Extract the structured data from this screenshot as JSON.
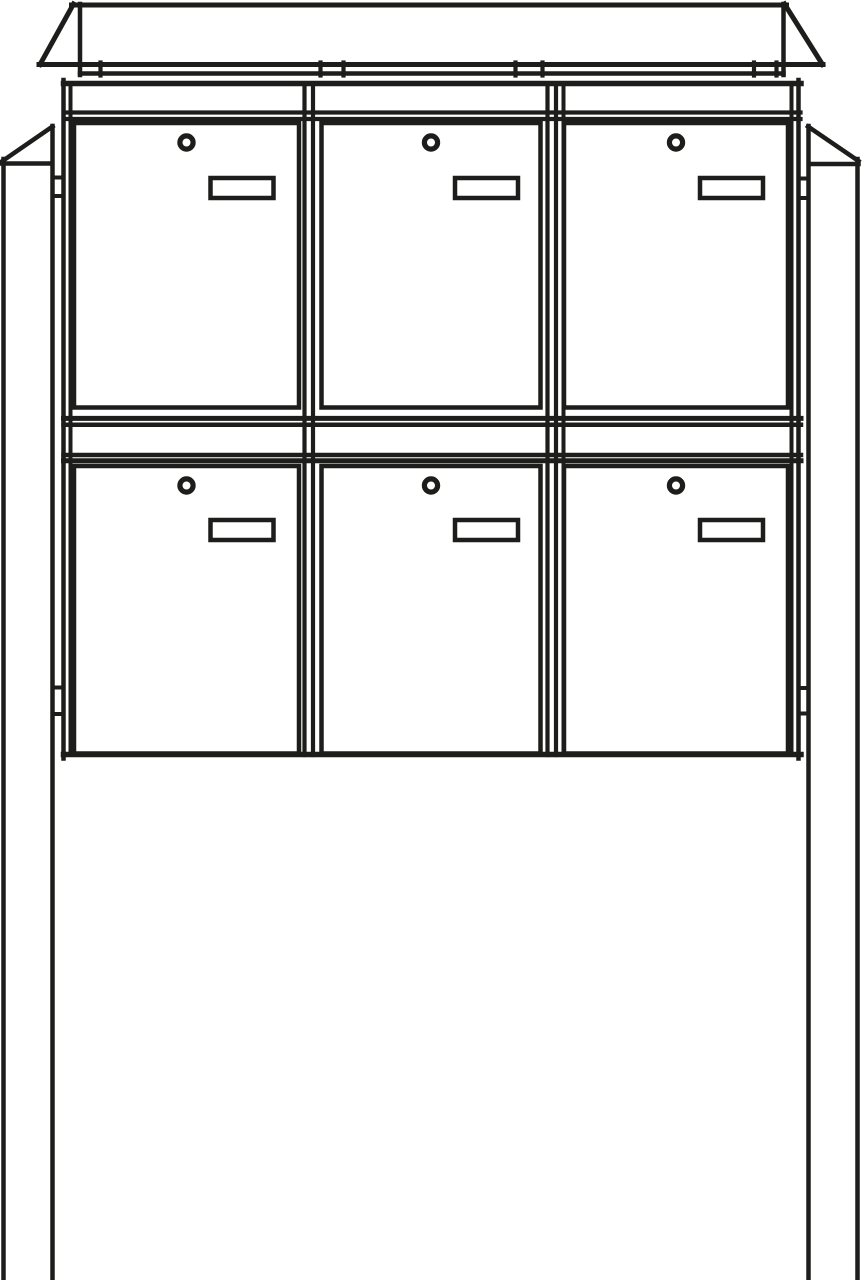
{
  "figure": {
    "kind": "technical-line-drawing",
    "subject": "Free-standing letterbox unit: 6 mailbox doors in 2 rows x 3 columns, each door with a round cylinder lock and a rectangular name plate, pitched rain cover on top, cabinet mounted on two square ground posts with side brackets",
    "rows": 2,
    "columns": 3,
    "door_count": 6
  },
  "canvas": {
    "width": 862,
    "height": 1280
  },
  "colors": {
    "background": "#ffffff",
    "line": "#1d1d1b"
  },
  "diagram": {
    "shapes": [
      {
        "kind": "line",
        "name": "roof-top-edge",
        "x1": 71.5,
        "y1": 5,
        "x2": 786.5,
        "y2": 5,
        "w": 5
      },
      {
        "kind": "line",
        "name": "roof-left-slope",
        "x1": 73.5,
        "y1": 4,
        "x2": 40,
        "y2": 64.5,
        "w": 5
      },
      {
        "kind": "line",
        "name": "roof-right-slope",
        "x1": 784.5,
        "y1": 4,
        "x2": 822.5,
        "y2": 64.5,
        "w": 5
      },
      {
        "kind": "line",
        "name": "roof-left-fold-line",
        "x1": 80,
        "y1": 4,
        "x2": 80,
        "y2": 75,
        "w": 4.5
      },
      {
        "kind": "line",
        "name": "roof-right-fold-line",
        "x1": 783.5,
        "y1": 4,
        "x2": 783.5,
        "y2": 75,
        "w": 4.5
      },
      {
        "kind": "line",
        "name": "roof-eave-rail",
        "x1": 39,
        "y1": 64.5,
        "x2": 823,
        "y2": 64.5,
        "w": 5
      },
      {
        "kind": "line",
        "name": "roof-under-rail",
        "x1": 80,
        "y1": 73.5,
        "x2": 783.5,
        "y2": 73.5,
        "w": 4.5
      },
      {
        "kind": "line",
        "name": "roof-bracket-tick-1",
        "x1": 100.5,
        "y1": 62.5,
        "x2": 100.5,
        "y2": 75.5,
        "w": 4.2
      },
      {
        "kind": "line",
        "name": "roof-bracket-tick-2",
        "x1": 320.5,
        "y1": 62.5,
        "x2": 320.5,
        "y2": 75.5,
        "w": 4.2
      },
      {
        "kind": "line",
        "name": "roof-bracket-tick-3",
        "x1": 343.5,
        "y1": 62.5,
        "x2": 343.5,
        "y2": 75.5,
        "w": 4.2
      },
      {
        "kind": "line",
        "name": "roof-bracket-tick-4",
        "x1": 515.5,
        "y1": 62.5,
        "x2": 515.5,
        "y2": 75.5,
        "w": 4.2
      },
      {
        "kind": "line",
        "name": "roof-bracket-tick-5",
        "x1": 542.5,
        "y1": 62.5,
        "x2": 542.5,
        "y2": 75.5,
        "w": 4.2
      },
      {
        "kind": "line",
        "name": "roof-bracket-tick-6",
        "x1": 754,
        "y1": 62.5,
        "x2": 754,
        "y2": 75.5,
        "w": 4.2
      },
      {
        "kind": "line",
        "name": "roof-bracket-tick-7",
        "x1": 776.5,
        "y1": 62.5,
        "x2": 776.5,
        "y2": 75.5,
        "w": 4.2
      },
      {
        "kind": "line",
        "name": "cabinet-left-frame-outer",
        "x1": 63.5,
        "y1": 80,
        "x2": 63.5,
        "y2": 758.5,
        "w": 4.5
      },
      {
        "kind": "line",
        "name": "cabinet-left-frame-inner",
        "x1": 70.5,
        "y1": 83,
        "x2": 70.5,
        "y2": 755,
        "w": 4
      },
      {
        "kind": "line",
        "name": "divider-1-left-line",
        "x1": 304.5,
        "y1": 84,
        "x2": 304.5,
        "y2": 755,
        "w": 4.2
      },
      {
        "kind": "line",
        "name": "divider-1-right-line",
        "x1": 313,
        "y1": 84,
        "x2": 313,
        "y2": 755,
        "w": 4.2
      },
      {
        "kind": "line",
        "name": "divider-2-left-line",
        "x1": 547.5,
        "y1": 84,
        "x2": 547.5,
        "y2": 755,
        "w": 4.2
      },
      {
        "kind": "line",
        "name": "divider-2-mid-line",
        "x1": 556,
        "y1": 84,
        "x2": 556,
        "y2": 755,
        "w": 4.2
      },
      {
        "kind": "line",
        "name": "divider-2-right-line",
        "x1": 563.5,
        "y1": 84,
        "x2": 563.5,
        "y2": 755,
        "w": 4
      },
      {
        "kind": "line",
        "name": "cabinet-right-frame-inner",
        "x1": 791.5,
        "y1": 83,
        "x2": 791.5,
        "y2": 755,
        "w": 4
      },
      {
        "kind": "line",
        "name": "cabinet-right-frame-outer",
        "x1": 798.5,
        "y1": 80,
        "x2": 798.5,
        "y2": 758.5,
        "w": 4.5
      },
      {
        "kind": "line",
        "name": "cabinet-top-rail",
        "x1": 63.5,
        "y1": 83.5,
        "x2": 801,
        "y2": 83.5,
        "w": 5.5
      },
      {
        "kind": "line",
        "name": "header-rail-upper",
        "x1": 64,
        "y1": 112.5,
        "x2": 800.5,
        "y2": 112.5,
        "w": 4.2
      },
      {
        "kind": "line",
        "name": "header-rail-lower",
        "x1": 64,
        "y1": 119,
        "x2": 800.5,
        "y2": 119,
        "w": 4.2
      },
      {
        "kind": "line",
        "name": "mid-rail-1",
        "x1": 63.5,
        "y1": 418.4,
        "x2": 801,
        "y2": 418.4,
        "w": 5
      },
      {
        "kind": "line",
        "name": "mid-rail-2",
        "x1": 63.5,
        "y1": 424.8,
        "x2": 801,
        "y2": 424.8,
        "w": 4.5
      },
      {
        "kind": "line",
        "name": "mid-rail-3",
        "x1": 63.5,
        "y1": 455,
        "x2": 801,
        "y2": 455,
        "w": 4.5
      },
      {
        "kind": "line",
        "name": "mid-rail-4",
        "x1": 63.5,
        "y1": 460.7,
        "x2": 801,
        "y2": 460.7,
        "w": 5
      },
      {
        "kind": "line",
        "name": "cabinet-bottom-rail",
        "x1": 63.5,
        "y1": 754.5,
        "x2": 801,
        "y2": 754.5,
        "w": 5.5
      },
      {
        "kind": "line",
        "name": "left-post-outer-edge",
        "x1": 3.5,
        "y1": 159,
        "x2": 3.5,
        "y2": 1280,
        "w": 4.5
      },
      {
        "kind": "line",
        "name": "left-post-inner-edge",
        "x1": 52.5,
        "y1": 126,
        "x2": 52.5,
        "y2": 1280,
        "w": 4.5
      },
      {
        "kind": "line",
        "name": "left-post-top-slope",
        "x1": 52.5,
        "y1": 126.5,
        "x2": 2.5,
        "y2": 161,
        "w": 4.5
      },
      {
        "kind": "line",
        "name": "left-post-chamfer-base",
        "x1": 2,
        "y1": 163.5,
        "x2": 52,
        "y2": 163.5,
        "w": 4.5
      },
      {
        "kind": "line",
        "name": "right-post-inner-edge",
        "x1": 808.5,
        "y1": 126,
        "x2": 808.5,
        "y2": 1280,
        "w": 4.5
      },
      {
        "kind": "line",
        "name": "right-post-outer-edge",
        "x1": 857.5,
        "y1": 159,
        "x2": 857.5,
        "y2": 1280,
        "w": 4.5
      },
      {
        "kind": "line",
        "name": "right-post-top-slope",
        "x1": 808,
        "y1": 126.5,
        "x2": 858.5,
        "y2": 161,
        "w": 4.5
      },
      {
        "kind": "line",
        "name": "right-post-chamfer-base",
        "x1": 809,
        "y1": 164,
        "x2": 858.5,
        "y2": 164,
        "w": 4.5
      },
      {
        "kind": "line",
        "name": "left-bracket-upper-top",
        "x1": 52.5,
        "y1": 177.5,
        "x2": 63.5,
        "y2": 177.5,
        "w": 4
      },
      {
        "kind": "line",
        "name": "left-bracket-upper-bottom",
        "x1": 52.5,
        "y1": 196,
        "x2": 63.5,
        "y2": 196,
        "w": 4
      },
      {
        "kind": "line",
        "name": "left-bracket-lower-top",
        "x1": 52.5,
        "y1": 687.5,
        "x2": 63.5,
        "y2": 687.5,
        "w": 4
      },
      {
        "kind": "line",
        "name": "left-bracket-lower-bottom",
        "x1": 52.5,
        "y1": 714,
        "x2": 63.5,
        "y2": 714,
        "w": 4
      },
      {
        "kind": "line",
        "name": "right-bracket-upper-top",
        "x1": 798.5,
        "y1": 178.5,
        "x2": 808.5,
        "y2": 178.5,
        "w": 4
      },
      {
        "kind": "line",
        "name": "right-bracket-upper-bottom",
        "x1": 798.5,
        "y1": 198,
        "x2": 808.5,
        "y2": 198,
        "w": 4
      },
      {
        "kind": "line",
        "name": "right-bracket-lower-top",
        "x1": 798.5,
        "y1": 688,
        "x2": 808.5,
        "y2": 688,
        "w": 4
      },
      {
        "kind": "line",
        "name": "right-bracket-lower-bottom",
        "x1": 798.5,
        "y1": 713.5,
        "x2": 808.5,
        "y2": 713.5,
        "w": 4
      },
      {
        "kind": "rect",
        "name": "door-1-top-left",
        "x": 74,
        "y": 123,
        "w": 225,
        "h": 284.5,
        "sw": 4.5,
        "fill": "#ffffff"
      },
      {
        "kind": "rect",
        "name": "door-2-top-middle",
        "x": 321.5,
        "y": 123,
        "w": 219,
        "h": 284.5,
        "sw": 4.5,
        "fill": "#ffffff"
      },
      {
        "kind": "rect",
        "name": "door-3-top-right",
        "x": 564,
        "y": 123,
        "w": 224,
        "h": 284.5,
        "sw": 4.5,
        "fill": "#ffffff"
      },
      {
        "kind": "rect",
        "name": "door-4-bottom-left",
        "x": 74,
        "y": 466,
        "w": 225,
        "h": 287.5,
        "sw": 4.5,
        "fill": "#ffffff"
      },
      {
        "kind": "rect",
        "name": "door-5-bottom-middle",
        "x": 321.5,
        "y": 466,
        "w": 219,
        "h": 287.5,
        "sw": 4.5,
        "fill": "#ffffff"
      },
      {
        "kind": "rect",
        "name": "door-6-bottom-right",
        "x": 564,
        "y": 466,
        "w": 224,
        "h": 287.5,
        "sw": 4.5,
        "fill": "#ffffff"
      },
      {
        "kind": "rect",
        "name": "door-1-nameplate",
        "x": 210.5,
        "y": 178,
        "w": 63,
        "h": 20,
        "sw": 4.5,
        "fill": "#ffffff"
      },
      {
        "kind": "rect",
        "name": "door-2-nameplate",
        "x": 455,
        "y": 178,
        "w": 63,
        "h": 20,
        "sw": 4.5,
        "fill": "#ffffff"
      },
      {
        "kind": "rect",
        "name": "door-3-nameplate",
        "x": 700,
        "y": 178,
        "w": 63,
        "h": 20,
        "sw": 4.5,
        "fill": "#ffffff"
      },
      {
        "kind": "rect",
        "name": "door-4-nameplate",
        "x": 210.5,
        "y": 520,
        "w": 63,
        "h": 20,
        "sw": 4.5,
        "fill": "#ffffff"
      },
      {
        "kind": "rect",
        "name": "door-5-nameplate",
        "x": 455,
        "y": 520,
        "w": 63,
        "h": 20,
        "sw": 4.5,
        "fill": "#ffffff"
      },
      {
        "kind": "rect",
        "name": "door-6-nameplate",
        "x": 700,
        "y": 520,
        "w": 63,
        "h": 20,
        "sw": 4.5,
        "fill": "#ffffff"
      },
      {
        "kind": "circle",
        "name": "door-1-lock",
        "cx": 186.5,
        "cy": 142.5,
        "r": 6.6,
        "sw": 5.2
      },
      {
        "kind": "circle",
        "name": "door-2-lock",
        "cx": 431,
        "cy": 142.5,
        "r": 6.6,
        "sw": 5.2
      },
      {
        "kind": "circle",
        "name": "door-3-lock",
        "cx": 676,
        "cy": 142.5,
        "r": 6.6,
        "sw": 5.2
      },
      {
        "kind": "circle",
        "name": "door-4-lock",
        "cx": 186.5,
        "cy": 485.5,
        "r": 6.6,
        "sw": 5.2
      },
      {
        "kind": "circle",
        "name": "door-5-lock",
        "cx": 431,
        "cy": 485.5,
        "r": 6.6,
        "sw": 5.2
      },
      {
        "kind": "circle",
        "name": "door-6-lock",
        "cx": 676,
        "cy": 485.5,
        "r": 6.6,
        "sw": 5.2
      }
    ]
  }
}
